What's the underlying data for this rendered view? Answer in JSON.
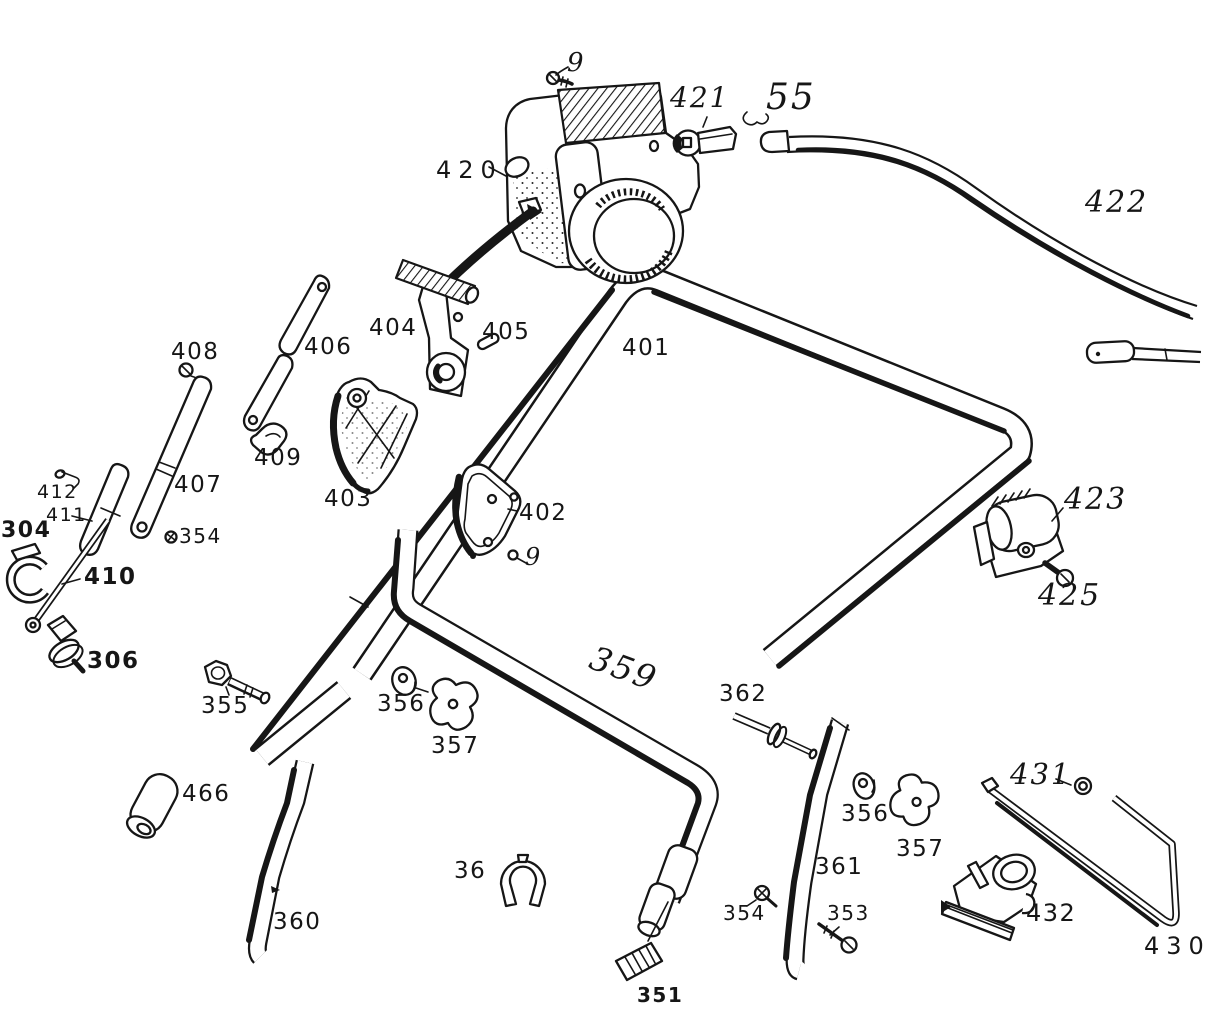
{
  "page": {
    "background": "#ffffff",
    "ink": "#161616"
  },
  "labels": {
    "p9_top": "9",
    "p421": "421",
    "p55": "55",
    "p420": "420",
    "p422": "422",
    "p408": "408",
    "p406": "406",
    "p404": "404",
    "p405": "405",
    "p401": "401",
    "p409": "409",
    "p403": "403",
    "p407": "407",
    "p412": "412",
    "p411": "411",
    "p304": "304",
    "p354_left": "354",
    "p410": "410",
    "p402": "402",
    "p9_mid": "9",
    "p423": "423",
    "p425": "425",
    "p306": "306",
    "p355": "355",
    "p356_left": "356",
    "p359": "359",
    "p357_left": "357",
    "p362": "362",
    "p466": "466",
    "p431": "431",
    "p356_right": "356",
    "p357_right": "357",
    "p36": "36",
    "p361": "361",
    "p360": "360",
    "p354_bottom": "354",
    "p353": "353",
    "p351": "351",
    "p432": "432",
    "p430": "430"
  }
}
